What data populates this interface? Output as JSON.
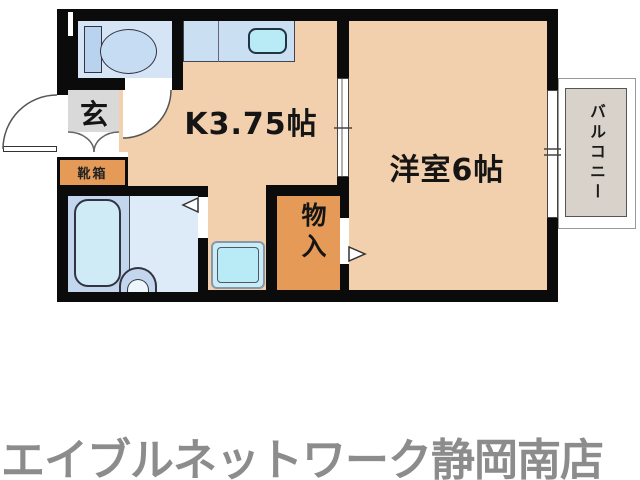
{
  "floorplan": {
    "kitchen_label": "K3.75帖",
    "western_room_label": "洋室6帖",
    "balcony_label": "バルコニー",
    "entrance_label": "玄",
    "shoebox_label": "靴箱",
    "storage_label": "物入"
  },
  "footer": {
    "store_name": "エイブルネットワーク静岡南店"
  },
  "colors": {
    "wall": "#0b0b0b",
    "floor": "#f2cfad",
    "counter-blue": "#cbdff3",
    "sink-cyan": "#b8ebf5",
    "toilet-blue": "#d6e5f6",
    "storage-orange": "#e59a58",
    "genkan-gray": "#d9d9d9",
    "balcony-gray": "#d8d2ca",
    "bath-left": "#c2d7ed",
    "bath-right": "#dcebf7",
    "tub": "#cfecf6",
    "logo-gray": "#8c8c8c"
  }
}
